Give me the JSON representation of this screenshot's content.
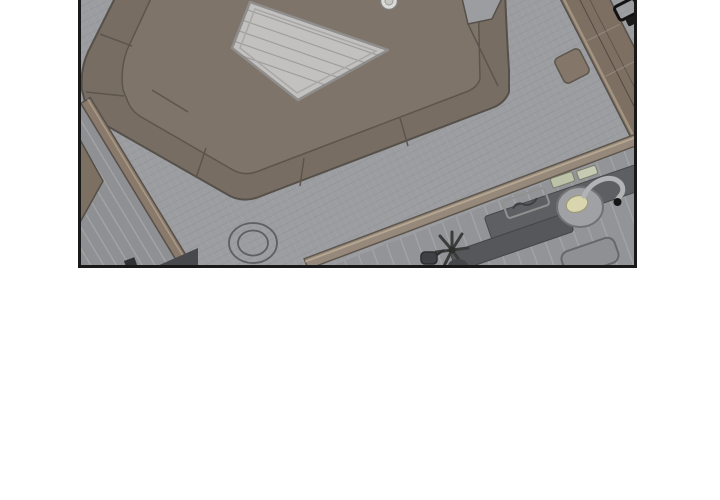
{
  "scene": {
    "title": "Comic panel: overhead apartment view",
    "description": "Black-bordered webtoon panel, cut off at the top, showing a rotated top-down view of an apartment: a square brown sofa pit with seams surrounds a light square table with a small cup beside it; a striped entry hallway with an open door sits at lower left behind a wooden wall strip; a kitchen with plank flooring at lower right holds two dark counters, an outlined tray, two pale green boards, a round sink with cream basin and gooseneck faucet, a potted plant, a kettle, and a gray stool; a wooden counter band with a black chair silhouette runs along the upper right border; a double-ring floor cushion lies on the gray living-room floor; white page background below the panel.",
    "panel_border_color": "#191919",
    "page_background": "#ffffff"
  },
  "palette": {
    "living_floor": "#9c9da0",
    "hallway_floor": "#8f9093",
    "kitchen_floor": "#939498",
    "sofa_brown": "#786d63",
    "sofa_inner": "#7f746a",
    "seam": "#5c554d",
    "table_top": "#c2c1bf",
    "table_edge": "#8f8e8c",
    "wood_trim": "#8a7b6c",
    "wood_highlight": "#b5a791",
    "counter_dark": "#5d5f62",
    "counter_darker": "#55575a",
    "sink_basin_cream": "#d9d5ae",
    "faucet_metal": "#b2b3b5",
    "plant_green": "#3a3e3a",
    "stool_gray": "#8e9093",
    "ink_black": "#161616"
  },
  "objects": [
    "sofa-pit",
    "coffee-table",
    "teacup",
    "floor-cushion-rings",
    "entry-hallway",
    "entry-door",
    "entry-wall",
    "kitchen-wall",
    "upper-kitchen-counter",
    "lower-kitchen-counter",
    "sink",
    "faucet",
    "serving-tray",
    "cutting-boards",
    "potted-plant",
    "kettle",
    "kitchen-stool",
    "right-wall-counter",
    "side-box",
    "black-chair"
  ]
}
